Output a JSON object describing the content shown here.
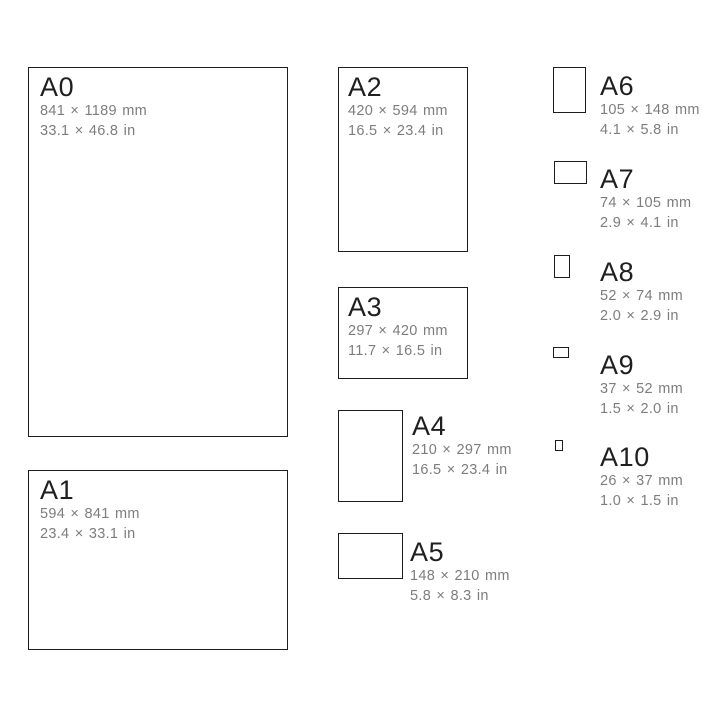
{
  "papers": [
    {
      "name": "A0",
      "mm": "841 × 1189 mm",
      "inches": "33.1 × 46.8 in"
    },
    {
      "name": "A1",
      "mm": "594 × 841 mm",
      "inches": "23.4 × 33.1 in"
    },
    {
      "name": "A2",
      "mm": "420 × 594 mm",
      "inches": "16.5 × 23.4 in"
    },
    {
      "name": "A3",
      "mm": "297 × 420 mm",
      "inches": "11.7 × 16.5 in"
    },
    {
      "name": "A4",
      "mm": "210 × 297 mm",
      "inches": "16.5 × 23.4 in"
    },
    {
      "name": "A5",
      "mm": "148 × 210 mm",
      "inches": "5.8 × 8.3 in"
    },
    {
      "name": "A6",
      "mm": "105 × 148 mm",
      "inches": "4.1 × 5.8 in"
    },
    {
      "name": "A7",
      "mm": "74 × 105 mm",
      "inches": "2.9 × 4.1 in"
    },
    {
      "name": "A8",
      "mm": "52 × 74 mm",
      "inches": "2.0 × 2.9 in"
    },
    {
      "name": "A9",
      "mm": "37 × 52 mm",
      "inches": "1.5 × 2.0 in"
    },
    {
      "name": "A10",
      "mm": "26 × 37 mm",
      "inches": "1.0 × 1.5 in"
    }
  ],
  "colors": {
    "background": "#ffffff",
    "border": "#1d1d1d",
    "title_text": "#1f1f1f",
    "dimension_text": "#7d7d7d"
  }
}
